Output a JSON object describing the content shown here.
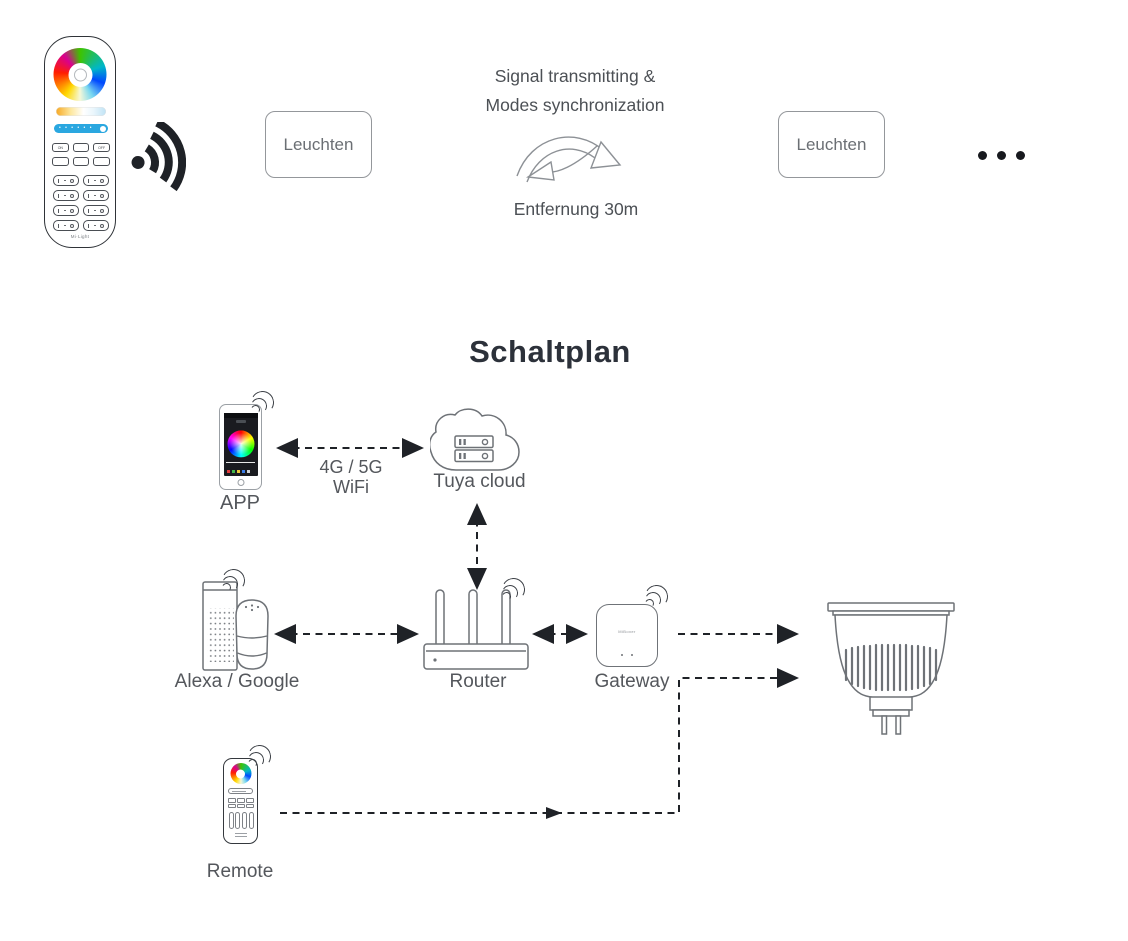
{
  "top": {
    "remote": {
      "brand": "Mi·Light",
      "btn_on": "ON",
      "btn_off": "OFF"
    },
    "box1_label": "Leuchten",
    "box2_label": "Leuchten",
    "signal_line1": "Signal transmitting &",
    "signal_line2": "Modes synchronization",
    "distance": "Entfernung 30m",
    "more_devices_icon": "ellipsis"
  },
  "diagram": {
    "title": "Schaltplan",
    "app_label": "APP",
    "link_line1": "4G / 5G",
    "link_line2": "WiFi",
    "tuya_label": "Tuya cloud",
    "alexa_label": "Alexa / Google",
    "router_label": "Router",
    "gateway_label": "Gateway",
    "gateway_brand": "MiBoxer",
    "remote_label": "Remote"
  },
  "icons": [
    "remote-8zone-icon",
    "rf-signal-icon",
    "sync-arrows-icon",
    "smartphone-icon",
    "wifi-arcs-icon",
    "cloud-server-icon",
    "smart-speaker-icon",
    "router-icon",
    "gateway-icon",
    "led-spotlight-icon",
    "remote-4zone-icon",
    "ellipsis-icon"
  ],
  "colors": {
    "ink": "#1f2227",
    "line_art": "#6e7277",
    "label": "#54575c",
    "accent_blue": "#2aa7e0"
  }
}
